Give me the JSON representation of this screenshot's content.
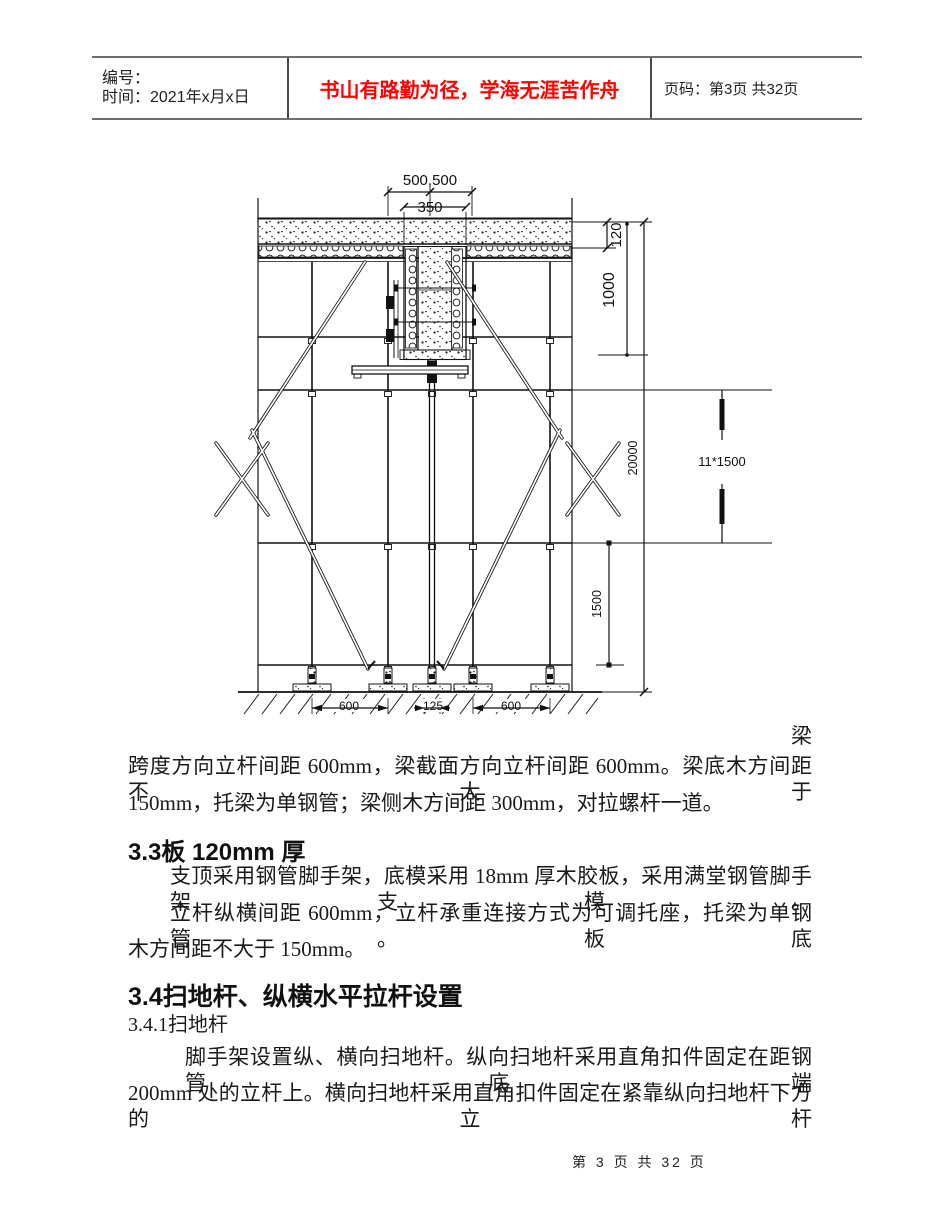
{
  "header": {
    "col1_line1": "编号：",
    "col1_line2": "时间：2021年x月x日",
    "slogan": "书山有路勤为径，学海无涯苦作舟",
    "slogan_color": "#ff0000",
    "page_info": "页码：第3页 共32页"
  },
  "diagram": {
    "dim_top_spans": "500,500",
    "dim_beam_width": "350",
    "dim_slab_thick": "120",
    "dim_beam_depth": "1000",
    "dim_total_height": "20000",
    "dim_lift_spacing": "11*1500",
    "dim_bottom_lift": "1500",
    "dim_base_left": "600",
    "dim_base_mid": "125",
    "dim_base_right": "600",
    "overflow_char": "梁"
  },
  "body": {
    "para_beam_line1": "跨度方向立杆间距 600mm，梁截面方向立杆间距 600mm。梁底木方间距不大于",
    "para_beam_line2": "150mm，托梁为单钢管；梁侧木方间距 300mm，对拉螺杆一道。",
    "h33": "3.3板 120mm 厚",
    "p33_1": "支顶采用钢管脚手架，底模采用 18mm 厚木胶板，采用满堂钢管脚手架支模。",
    "p33_2_line1": "立杆纵横间距 600mm，立杆承重连接方式为可调托座，托梁为单钢管。板底",
    "p33_2_line2": "木方间距不大于 150mm。",
    "h34": "3.4扫地杆、纵横水平拉杆设置",
    "h341": "3.4.1扫地杆",
    "p34_line1": "脚手架设置纵、横向扫地杆。纵向扫地杆采用直角扣件固定在距钢管底端",
    "p34_line2": "200mm 处的立杆上。横向扫地杆采用直角扣件固定在紧靠纵向扫地杆下方的立杆"
  },
  "footer": {
    "page_text": "第 3 页 共 32 页"
  }
}
